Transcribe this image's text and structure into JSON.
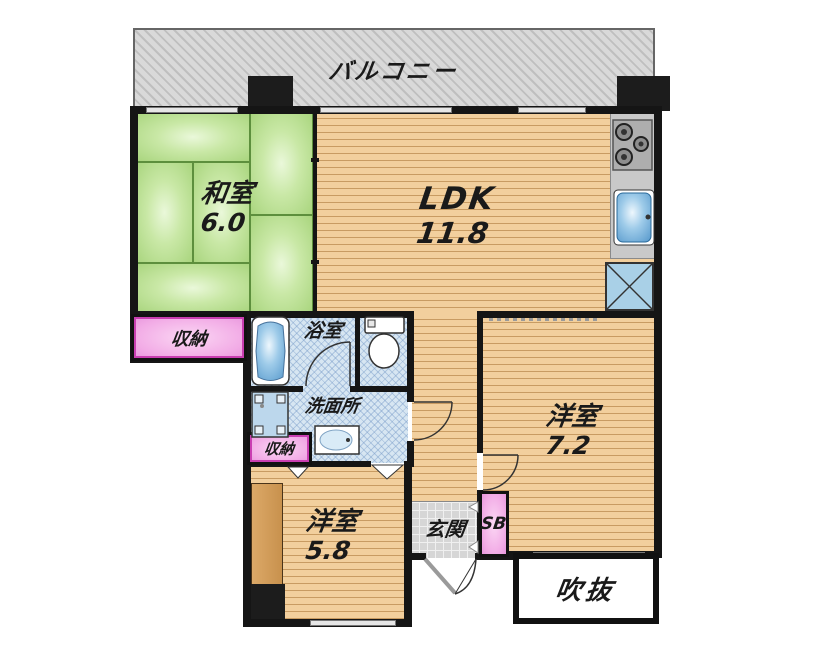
{
  "plan_title": "floor-plan",
  "rooms": {
    "balcony": {
      "label": "バルコニー"
    },
    "washitsu": {
      "label": "和室",
      "area": "6.0"
    },
    "ldk": {
      "label": "LDK",
      "area": "11.8"
    },
    "bathroom": {
      "label": "浴室"
    },
    "washroom": {
      "label": "洗面所"
    },
    "storage_left": {
      "label": "収納"
    },
    "storage_mid": {
      "label": "収納"
    },
    "bedroom_right": {
      "label": "洋室",
      "area": "7.2"
    },
    "bedroom_bottom": {
      "label": "洋室",
      "area": "5.8"
    },
    "genkan": {
      "label": "玄関"
    },
    "shoe_box": {
      "label": "SB"
    },
    "void_space": {
      "label": "吹抜"
    }
  },
  "fixtures": [
    "bathtub-icon",
    "toilet-icon",
    "washing-machine-pan-icon",
    "vanity-sink-icon",
    "gas-stove-icon",
    "kitchen-sink-icon",
    "refrigerator-space-icon",
    "entrance-double-door-icon"
  ],
  "colors": {
    "tatami_green": "#b8e09a",
    "wood_floor": "#f0cb93",
    "wood_line": "#c89b62",
    "wet_blue": "#d7e6f2",
    "storage_pink": "#f2ace6",
    "tile_gray": "#d6d6d6",
    "balcony_gray": "#d4d4d4",
    "wall_black": "#151515",
    "fixture_blue": "#8ec3e8"
  }
}
